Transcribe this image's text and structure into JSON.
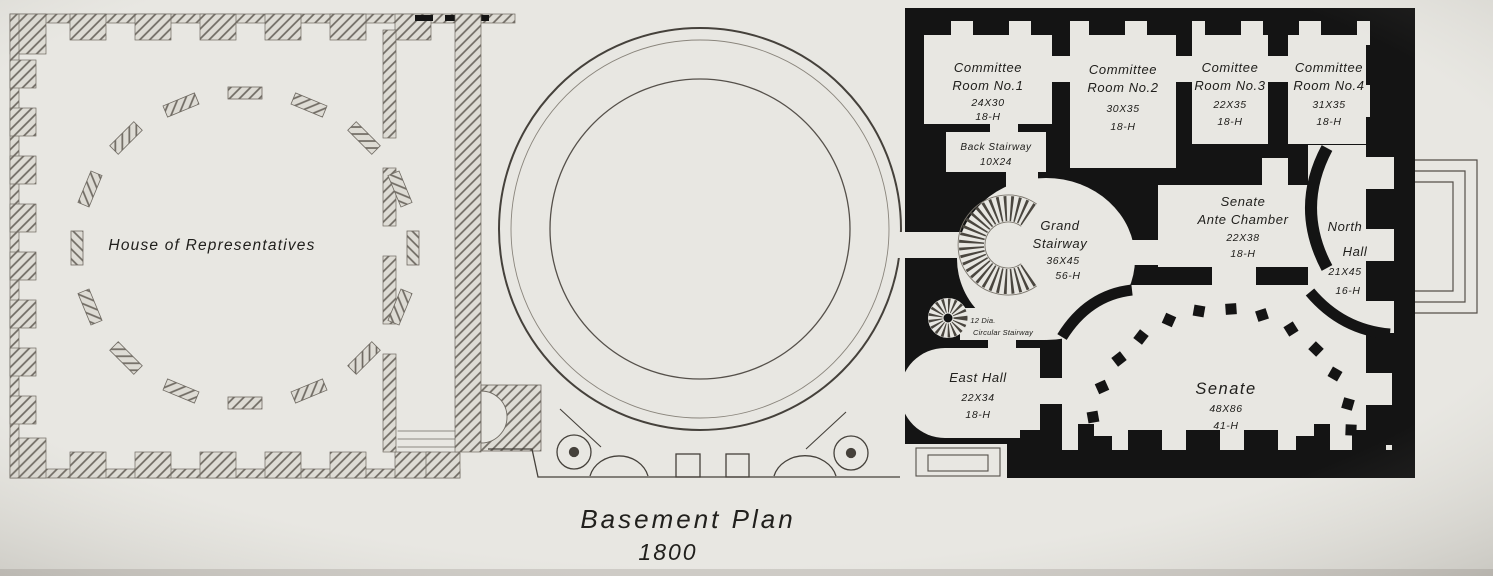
{
  "figure": {
    "caption": {
      "title": "Basement Plan",
      "year": "1800"
    },
    "house_wing": {
      "label": "House of Representatives"
    },
    "senate_wing": {
      "committee_room_1": {
        "lines": [
          "Committee",
          "Room No.1",
          "24X30",
          "18-H"
        ]
      },
      "committee_room_2": {
        "lines": [
          "Committee",
          "Room No.2",
          "30X35",
          "18-H"
        ]
      },
      "committee_room_3": {
        "lines": [
          "Comittee",
          "Room No.3",
          "22X35",
          "18-H"
        ]
      },
      "committee_room_4": {
        "lines": [
          "Committee",
          "Room No.4",
          "31X35",
          "18-H"
        ]
      },
      "back_stairway": {
        "lines": [
          "Back Stairway",
          "10X24"
        ]
      },
      "grand_stairway": {
        "lines": [
          "Grand",
          "Stairway",
          "36X45",
          "56-H"
        ]
      },
      "circular_stairway": {
        "lines": [
          "12 Dia.",
          "Circular Stairway"
        ]
      },
      "senate_ante_chamber": {
        "lines": [
          "Senate",
          "Ante Chamber",
          "22X38",
          "18-H"
        ]
      },
      "north_hall": {
        "lines": [
          "North",
          "Hall",
          "21X45",
          "16-H"
        ]
      },
      "east_hall": {
        "lines": [
          "East Hall",
          "22X34",
          "18-H"
        ]
      },
      "senate_chamber": {
        "lines": [
          "Senate",
          "48X86",
          "41-H"
        ]
      }
    },
    "colors": {
      "paper": "#e8e7e2",
      "wall_ink": "#141414",
      "hatch_line": "#6f6a62",
      "text_ink": "#21201d"
    }
  }
}
